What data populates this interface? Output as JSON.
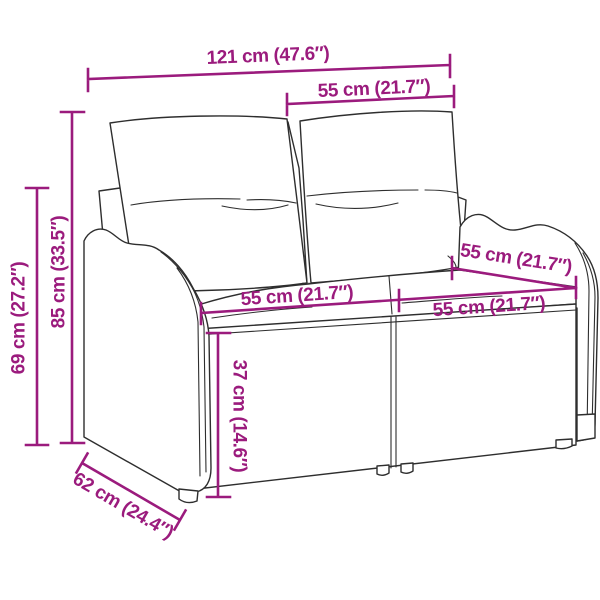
{
  "diagram": {
    "type": "product-dimension-diagram",
    "subject": "2-seat poly rattan garden bench with back and seat cushions",
    "labels": {
      "overall_width": "121 cm (47.6″)",
      "backrest_width": "55 cm (21.7″)",
      "overall_height": "85 cm (33.5″)",
      "armrest_height": "69 cm (27.2″)",
      "seat_width_left": "55 cm (21.7″)",
      "seat_width_right": "55 cm (21.7″)",
      "armrest_depth": "55 cm (21.7″)",
      "seat_height": "37 cm (14.6″)",
      "overall_depth": "62 cm (24.4″)"
    },
    "colors": {
      "dimension_accent": "#9b1b7d",
      "line_art": "#2e2e2e",
      "weave_texture": "#6e6e6e",
      "cushion_fill": "#ffffff",
      "background": "#ffffff"
    }
  }
}
